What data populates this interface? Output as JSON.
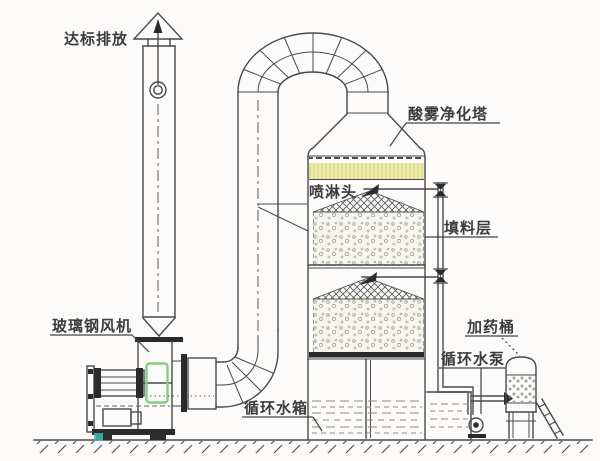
{
  "diagram": {
    "labels": {
      "emission": "达标排放",
      "fan": "玻璃钢风机",
      "tower": "酸雾净化塔",
      "spray_head": "喷淋头",
      "packing_layer": "填料层",
      "dosing_barrel": "加药桶",
      "circulating_pump": "循环水泵",
      "circulating_tank": "循环水箱"
    },
    "colors": {
      "demister_yellow": "#ecedab",
      "fan_highlight_green": "#85cd80",
      "accent_teal": "#3fb8b6",
      "line_dark": "#4a4a4a"
    }
  }
}
